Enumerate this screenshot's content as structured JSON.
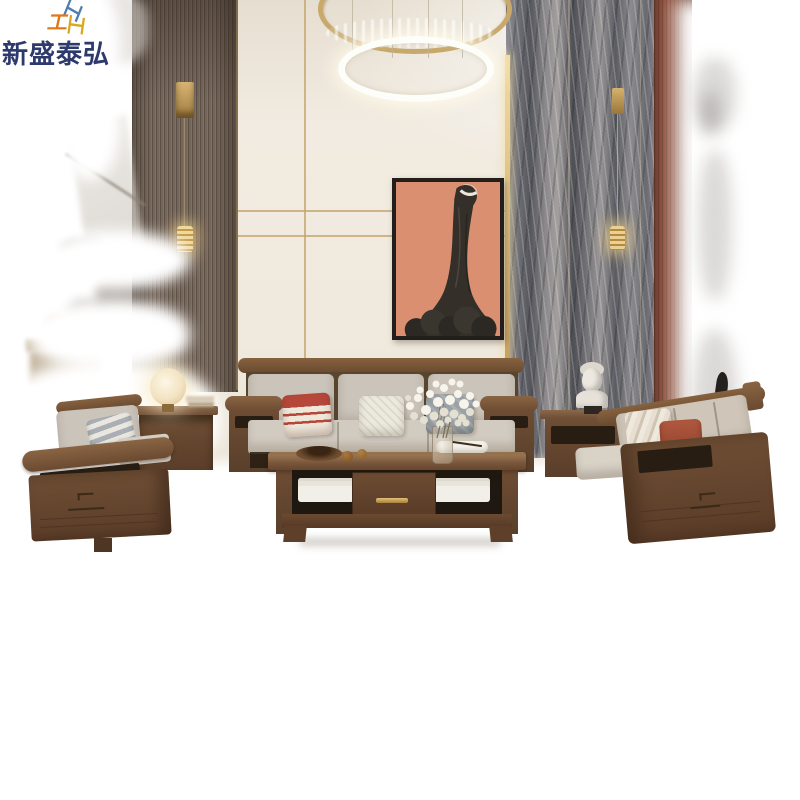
{
  "watermark": {
    "brand_text": "新盛泰弘",
    "brand_color": "#2d3a6b",
    "logo_icon": "isometric-blocks-logo",
    "logo_colors": {
      "blue": "#4e7fb0",
      "orange": "#e0771b",
      "yellow": "#d9a81e"
    }
  },
  "scene": {
    "kind": "furniture-product-photo",
    "setting": "modern living room with wood panel wall, cream wall with gold trim and gray marble feature wall, matted on white",
    "elements": [
      "double-ring-crystal-chandelier",
      "portrait-wall-art-woman-in-black-dress",
      "wood-panel-wall-left",
      "cream-wall-gold-trim",
      "marble-feature-wall-right",
      "red-wood-column-right",
      "wall-sconce-pendant-left",
      "wall-sconce-pendant-right",
      "single-armchair-walnut",
      "three-seat-sofa-walnut",
      "two-seat-sofa-walnut",
      "coffee-table-with-drawer",
      "side-table-left-with-sphere-lamp",
      "side-table-right-with-bust-sculpture",
      "glowing-sphere-table-lamp",
      "white-bust-sculpture",
      "baby-breath-flower-vase",
      "fruit-bowl",
      "striped-red-pillow",
      "white-knit-pillow",
      "gray-pillow",
      "rust-pillow"
    ],
    "palette": {
      "background_white": "#ffffff",
      "wall_cream": "#efe8dd",
      "wood_panel": "#75665a",
      "gold_trim": "#c3a26b",
      "marble_gray": "#77777c",
      "wood_column_red": "#8a4c38",
      "painting_background": "#d98f70",
      "painting_dress": "#343029",
      "sofa_wood": "#6f4e34",
      "cushion_gray": "#cbc4ba",
      "pillow_red": "#b5483a",
      "pillow_rust": "#a8503c",
      "lamp_glow": "#f7ecd2"
    }
  }
}
